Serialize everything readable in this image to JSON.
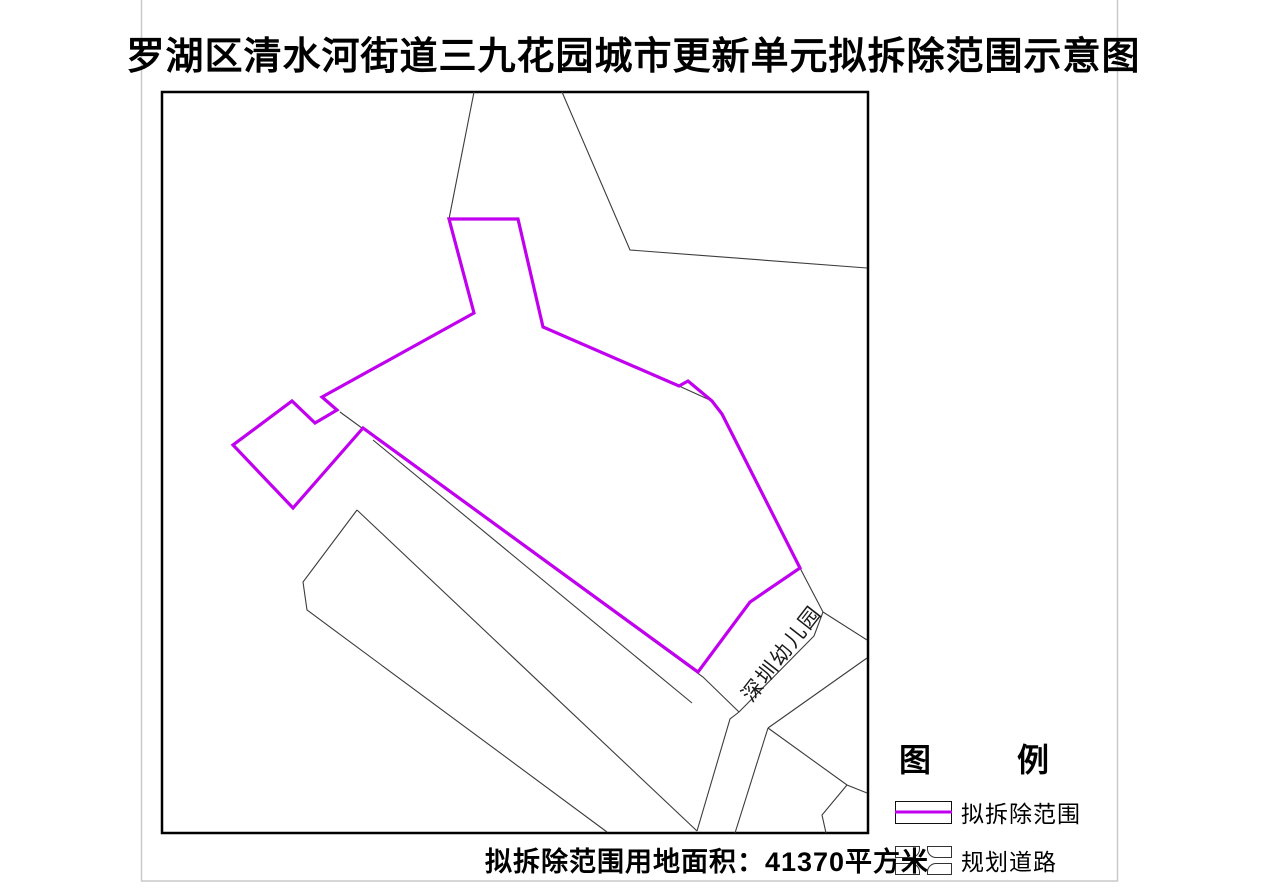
{
  "page": {
    "title": "罗湖区清水河街道三九花园城市更新单元拟拆除范围示意图",
    "caption": "拟拆除范围用地面积：41370平方米"
  },
  "map": {
    "kindergarten_label": "深圳幼儿园"
  },
  "legend": {
    "title_left": "图",
    "title_right": "例",
    "items": [
      {
        "label": "拟拆除范围",
        "symbol": "demolition-boundary-line"
      },
      {
        "label": "规划道路",
        "symbol": "planned-road-intersection"
      }
    ]
  },
  "colors": {
    "demolition_boundary": "#C000EE",
    "parcel_line": "#3c3c3c",
    "map_frame": "#000000",
    "page_border": "#c9c9c9"
  }
}
